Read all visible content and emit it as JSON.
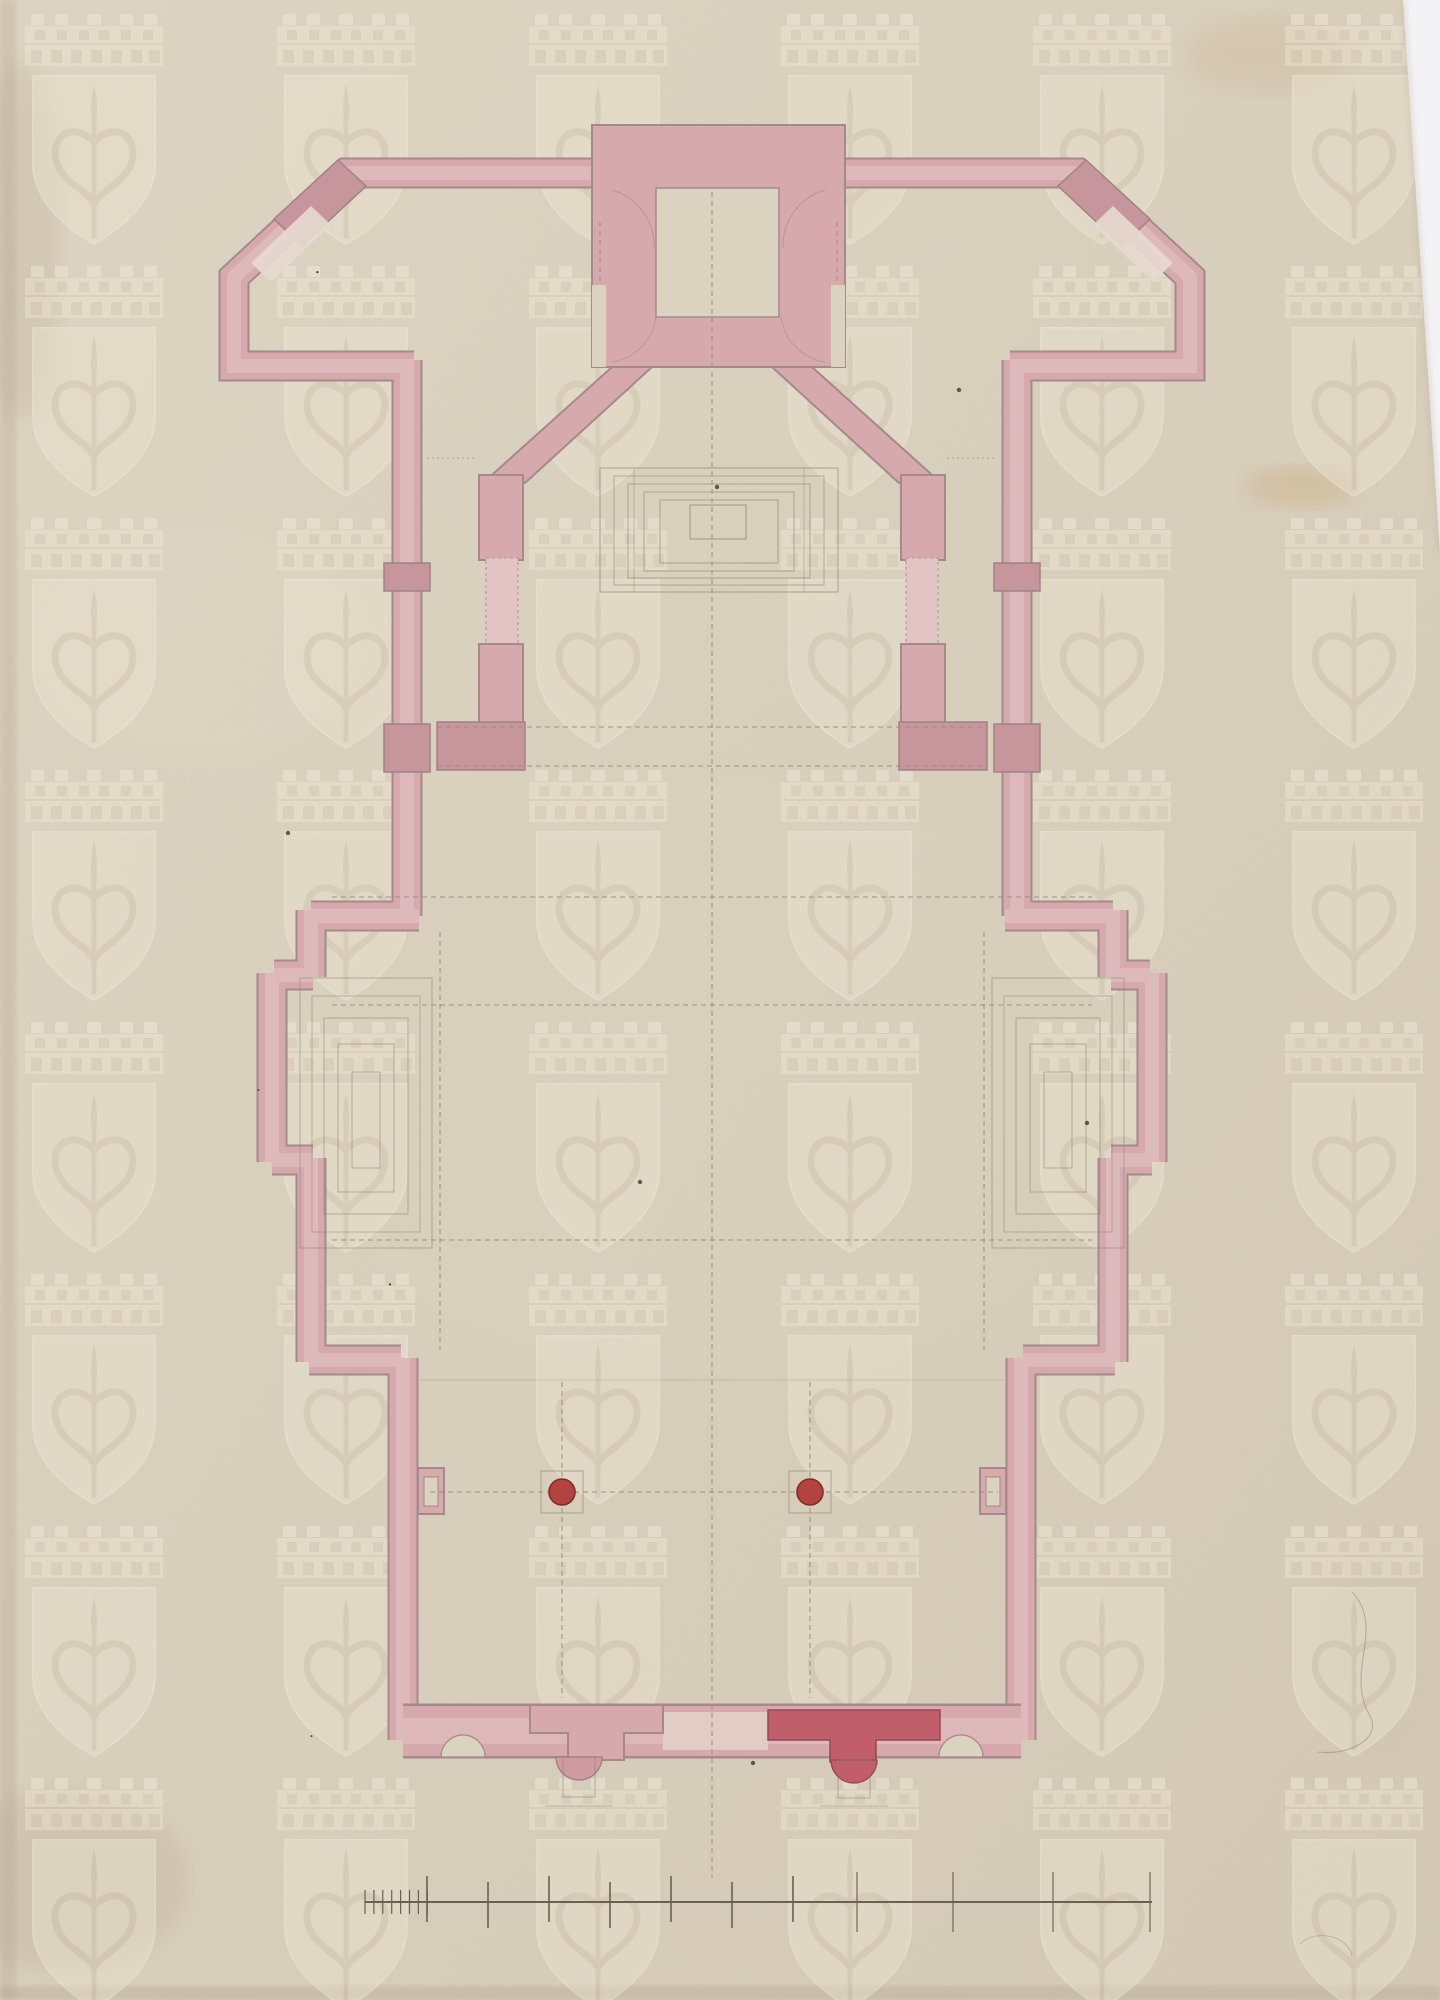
{
  "document": {
    "kind": "scanned-architectural-drawing",
    "description": "Hand-drawn church floor plan in pink watercolour wash and graphite on aged cream paper, with a tiled shield-and-crown archive watermark, ink spatter, stains and a graphite scale bar at the bottom."
  },
  "palette": {
    "paper": "#d9cfbd",
    "paper_light": "#ded4c3",
    "paper_dark": "#cfc4b1",
    "scan_background": "#f3f3f5",
    "wash_pink": "#d6a9ad",
    "wash_pink_deep": "#c7959c",
    "wash_crimson": "#c05f6b",
    "column_red": "#b2433e",
    "wall_outline": "#a5898c",
    "pencil": "#8d8170",
    "ink_speckle": "#42382c",
    "watermark_light": "#f0e9d8"
  },
  "watermark": {
    "cols": [
      29,
      281,
      533,
      785,
      1037,
      1289
    ],
    "rows": [
      14,
      266,
      518,
      770,
      1022,
      1274,
      1526,
      1778
    ],
    "opacity": 0.5
  },
  "plan": {
    "axis_x": 712
  },
  "red_columns": {
    "positions": [
      [
        562,
        1492
      ],
      [
        810,
        1492
      ]
    ],
    "radius": 13,
    "fill": "#b2433e",
    "stroke": "#7e2d2c",
    "base_half": 21
  },
  "dashed_lines": [
    {
      "x1": 437,
      "y1": 727,
      "x2": 987,
      "y2": 727
    },
    {
      "x1": 437,
      "y1": 766,
      "x2": 987,
      "y2": 766
    },
    {
      "x1": 332,
      "y1": 897,
      "x2": 1092,
      "y2": 897
    },
    {
      "x1": 332,
      "y1": 1005,
      "x2": 1092,
      "y2": 1005
    },
    {
      "x1": 332,
      "y1": 1240,
      "x2": 1092,
      "y2": 1240
    },
    {
      "x1": 430,
      "y1": 1492,
      "x2": 998,
      "y2": 1492
    },
    {
      "x1": 440,
      "y1": 932,
      "x2": 440,
      "y2": 1350
    },
    {
      "x1": 984,
      "y1": 932,
      "x2": 984,
      "y2": 1350
    },
    {
      "x1": 562,
      "y1": 1382,
      "x2": 562,
      "y2": 1698
    },
    {
      "x1": 810,
      "y1": 1382,
      "x2": 810,
      "y2": 1698
    },
    {
      "x1": 600,
      "y1": 222,
      "x2": 600,
      "y2": 283
    },
    {
      "x1": 837,
      "y1": 222,
      "x2": 837,
      "y2": 283
    },
    {
      "x1": 712,
      "y1": 192,
      "x2": 712,
      "y2": 1878,
      "axis": true
    }
  ],
  "scale_bar": {
    "y": 1902,
    "x_start": 365,
    "x_end": 1152,
    "minor_ticks": {
      "x_start": 365,
      "count": 8,
      "spacing": 8.9,
      "half_height": 12
    },
    "major_ticks": [
      427,
      488,
      549,
      610,
      671,
      732,
      793
    ],
    "sparse_ticks": [
      857,
      953,
      1053,
      1150
    ]
  },
  "speckles": {
    "clusters": [
      {
        "cx": 316,
        "cy": 272,
        "r": 34,
        "n": 16,
        "seed": 7
      },
      {
        "cx": 388,
        "cy": 1284,
        "r": 52,
        "n": 26,
        "seed": 11
      },
      {
        "cx": 258,
        "cy": 1090,
        "r": 14,
        "n": 3,
        "seed": 3
      },
      {
        "cx": 311,
        "cy": 1736,
        "r": 12,
        "n": 4,
        "seed": 5
      }
    ],
    "singles": [
      [
        288,
        833
      ],
      [
        1087,
        1123
      ],
      [
        753,
        1763
      ],
      [
        640,
        1182
      ],
      [
        959,
        390
      ],
      [
        717,
        487
      ]
    ]
  },
  "stains": [
    {
      "cx": 1300,
      "cy": 487,
      "rx": 55,
      "ry": 20,
      "color": "#c2a05e",
      "opacity": 0.28
    },
    {
      "cx": 1268,
      "cy": 55,
      "rx": 80,
      "ry": 38,
      "color": "#c7ab7c",
      "opacity": 0.2
    },
    {
      "cx": 60,
      "cy": 1880,
      "rx": 130,
      "ry": 90,
      "color": "#a89a82",
      "opacity": 0.18
    },
    {
      "cx": 1380,
      "cy": 1650,
      "rx": 60,
      "ry": 120,
      "color": "#cdbd9f",
      "opacity": 0.15
    },
    {
      "cx": 200,
      "cy": 640,
      "rx": 160,
      "ry": 120,
      "color": "#e3dac9",
      "opacity": 0.25
    },
    {
      "cx": 712,
      "cy": 1080,
      "rx": 420,
      "ry": 300,
      "color": "#e0d6c4",
      "opacity": 0.16
    },
    {
      "cx": 20,
      "cy": 240,
      "rx": 40,
      "ry": 180,
      "color": "#b3a58d",
      "opacity": 0.22
    }
  ]
}
